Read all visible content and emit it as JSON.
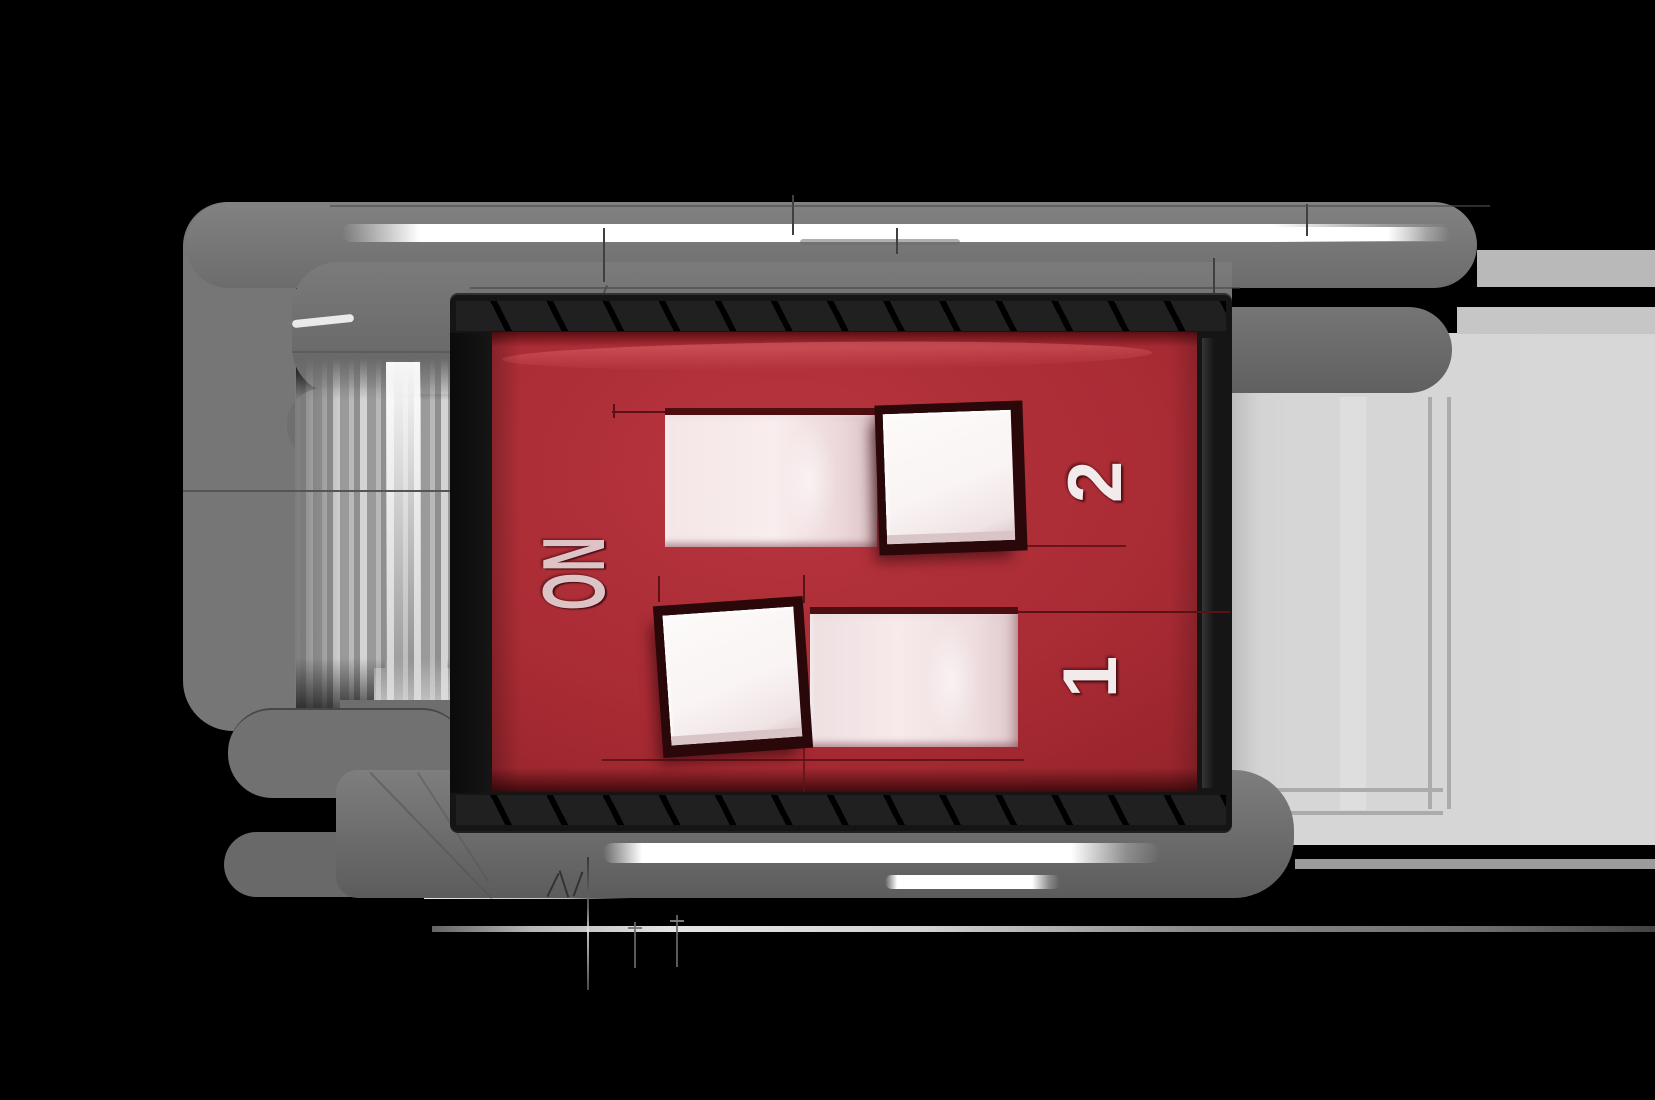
{
  "component": {
    "kind": "dip-switch-illustration",
    "positions": 2,
    "on_label": "ON",
    "switches": [
      {
        "id": 1,
        "label": "1",
        "state": "ON"
      },
      {
        "id": 2,
        "label": "2",
        "state": "OFF"
      }
    ],
    "colors": {
      "background": "#000000",
      "body_red": "#a92b34",
      "body_red_dark": "#651116",
      "frame_black": "#151515",
      "pin_gray": "#767676",
      "shadow_gray": "#d6d6d6",
      "slider_white": "#faf4f4",
      "slot_pink": "#f4e6e7",
      "label_color": "#f3eaeb"
    }
  }
}
